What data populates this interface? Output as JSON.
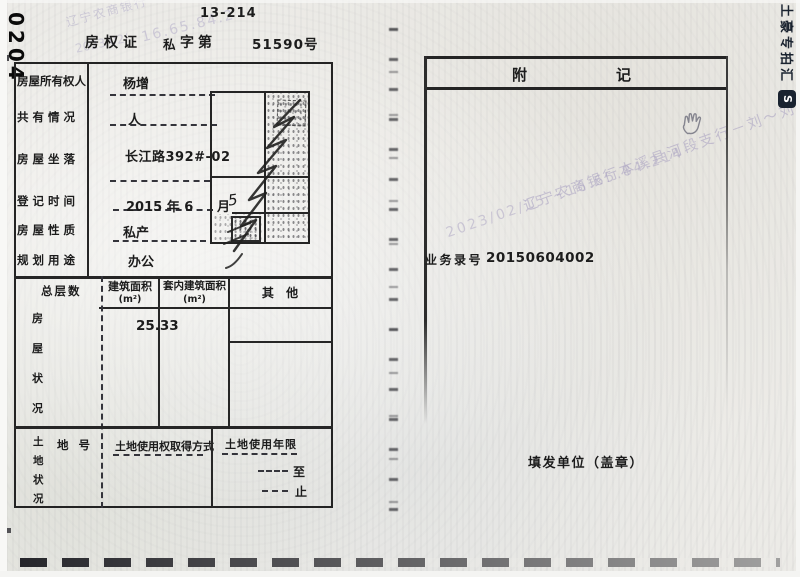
{
  "header": {
    "doc_code": "0204",
    "page_code": "13-214",
    "title": "房权证",
    "category": "私",
    "zidi": "字第",
    "serial": "51590号"
  },
  "owner_table": {
    "rows": [
      {
        "label": "房屋所有权人",
        "value": "杨增"
      },
      {
        "label": "共 有 情 况",
        "value": "人"
      },
      {
        "label": "房 屋 坐 落",
        "value": "长江路392#-02"
      },
      {
        "label": "登 记 时 间",
        "value": "2015 年 6",
        "value2": "月",
        "handwritten": "5"
      },
      {
        "label": "房 屋 性 质",
        "value": "私产"
      },
      {
        "label": "规 划 用 途",
        "value": "办公"
      }
    ]
  },
  "building_section": {
    "side_label_chars": [
      "房",
      "屋",
      "状",
      "况"
    ],
    "col_floors": "总层数",
    "col_area": "建筑面积",
    "col_area_unit": "(m²)",
    "col_inner_area": "套内建筑面积",
    "col_inner_area_unit": "(m²)",
    "col_other": "其 他",
    "area_value": "25.33"
  },
  "land_section": {
    "side_label_chars": [
      "土",
      "地",
      "状",
      "况"
    ],
    "col_parcel": "地 号",
    "col_acquire": "土地使用权取得方式",
    "col_tenure": "土地使用年限",
    "tenure_to": "至",
    "tenure_end": "止"
  },
  "appendix": {
    "title_left": "附",
    "title_right": "记",
    "business_no_label": "业务录号",
    "business_no_value": "20150604002",
    "issuer_label": "填发单位（盖章）"
  },
  "watermarks": {
    "bank_line": "辽宁农商银行本溪县河段支行－刘～刘",
    "stamp_line": "2023/02/15 ~16.65.84.214",
    "left_bank": "辽宁农商银行",
    "left_ip": "16.65.84.2",
    "left_date": "2023/02/",
    "side_brand": "土豪专拍汇",
    "side_brand_icon": "S"
  }
}
